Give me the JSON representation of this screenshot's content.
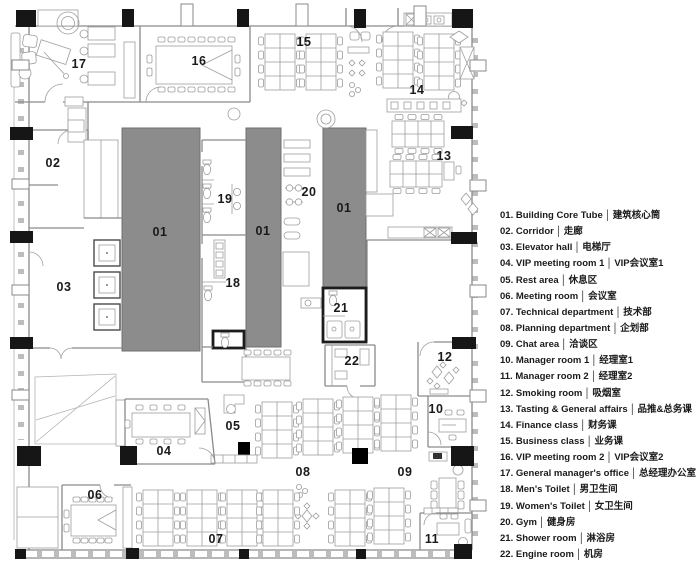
{
  "legend": {
    "separator": "│",
    "items": [
      {
        "num": "01.",
        "en": "Building Core Tube",
        "zh": "建筑核心筒"
      },
      {
        "num": "02.",
        "en": "Corridor",
        "zh": "走廊"
      },
      {
        "num": "03.",
        "en": "Elevator hall",
        "zh": "电梯厅"
      },
      {
        "num": "04.",
        "en": "VIP meeting room 1",
        "zh": "VIP会议室1"
      },
      {
        "num": "05.",
        "en": "Rest area",
        "zh": "休息区"
      },
      {
        "num": "06.",
        "en": "Meeting room",
        "zh": "会议室"
      },
      {
        "num": "07.",
        "en": "Technical department",
        "zh": "技术部"
      },
      {
        "num": "08.",
        "en": "Planning department",
        "zh": "企划部"
      },
      {
        "num": "09.",
        "en": "Chat area",
        "zh": "洽谈区"
      },
      {
        "num": "10.",
        "en": "Manager room 1",
        "zh": "经理室1"
      },
      {
        "num": "11.",
        "en": "Manager room 2",
        "zh": "经理室2"
      },
      {
        "num": "12.",
        "en": "Smoking room",
        "zh": "吸烟室"
      },
      {
        "num": "13.",
        "en": "Tasting & General affairs",
        "zh": "品推&总务课"
      },
      {
        "num": "14.",
        "en": "Finance class",
        "zh": "财务课"
      },
      {
        "num": "15.",
        "en": "Business class",
        "zh": "业务课"
      },
      {
        "num": "16.",
        "en": "VIP meeting room 2",
        "zh": "VIP会议室2"
      },
      {
        "num": "17.",
        "en": "General manager's office",
        "zh": "总经理办公室"
      },
      {
        "num": "18.",
        "en": "Men's Toilet",
        "zh": "男卫生间"
      },
      {
        "num": "19.",
        "en": "Women's Toilet",
        "zh": "女卫生间"
      },
      {
        "num": "20.",
        "en": "Gym",
        "zh": "健身房"
      },
      {
        "num": "21.",
        "en": "Shower room",
        "zh": "淋浴房"
      },
      {
        "num": "22.",
        "en": "Engine room",
        "zh": "机房"
      }
    ]
  },
  "plan": {
    "room_labels": [
      {
        "room": "01",
        "text": "01",
        "x": 160,
        "y": 236
      },
      {
        "room": "01",
        "text": "01",
        "x": 263,
        "y": 235
      },
      {
        "room": "01",
        "text": "01",
        "x": 344,
        "y": 212
      },
      {
        "room": "02",
        "text": "02",
        "x": 53,
        "y": 167
      },
      {
        "room": "03",
        "text": "03",
        "x": 64,
        "y": 291
      },
      {
        "room": "04",
        "text": "04",
        "x": 164,
        "y": 455
      },
      {
        "room": "05",
        "text": "05",
        "x": 233,
        "y": 430
      },
      {
        "room": "06",
        "text": "06",
        "x": 95,
        "y": 499
      },
      {
        "room": "07",
        "text": "07",
        "x": 216,
        "y": 543
      },
      {
        "room": "08",
        "text": "08",
        "x": 303,
        "y": 476
      },
      {
        "room": "09",
        "text": "09",
        "x": 405,
        "y": 476
      },
      {
        "room": "10",
        "text": "10",
        "x": 436,
        "y": 413
      },
      {
        "room": "11",
        "text": "11",
        "x": 432,
        "y": 543
      },
      {
        "room": "12",
        "text": "12",
        "x": 445,
        "y": 361
      },
      {
        "room": "13",
        "text": "13",
        "x": 444,
        "y": 160
      },
      {
        "room": "14",
        "text": "14",
        "x": 417,
        "y": 94
      },
      {
        "room": "15",
        "text": "15",
        "x": 304,
        "y": 46
      },
      {
        "room": "16",
        "text": "16",
        "x": 199,
        "y": 65
      },
      {
        "room": "17",
        "text": "17",
        "x": 79,
        "y": 68
      },
      {
        "room": "18",
        "text": "18",
        "x": 233,
        "y": 287
      },
      {
        "room": "19",
        "text": "19",
        "x": 225,
        "y": 203
      },
      {
        "room": "20",
        "text": "20",
        "x": 309,
        "y": 196
      },
      {
        "room": "21",
        "text": "21",
        "x": 341,
        "y": 312
      },
      {
        "room": "22",
        "text": "22",
        "x": 352,
        "y": 365
      }
    ],
    "colors": {
      "background": "#ffffff",
      "core_fill": "#8c8c8c",
      "core_stroke": "#6f6f6f",
      "wall": "#8a8a8a",
      "furniture": "#9d9d9d",
      "column": "#161616",
      "label": "#1a1a1a"
    }
  }
}
